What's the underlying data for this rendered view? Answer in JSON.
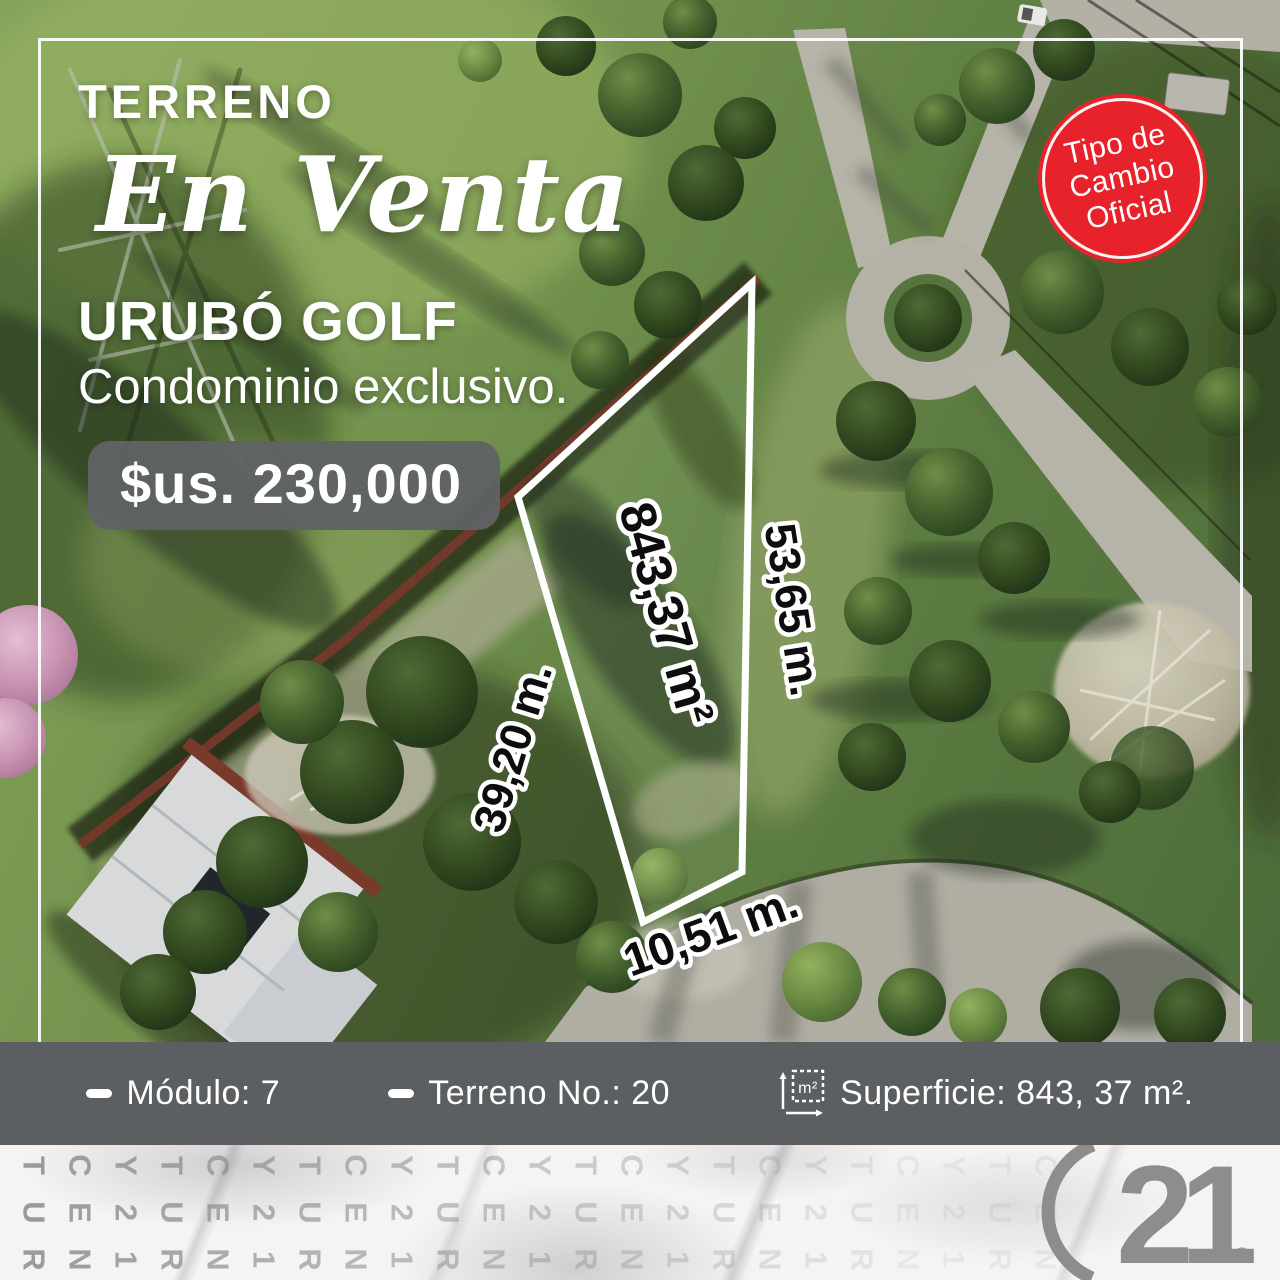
{
  "header": {
    "kicker": "TERRENO",
    "script_title": "En Venta",
    "location": "URUBÓ GOLF",
    "subtitle": "Condominio exclusivo.",
    "price": "$us. 230,000"
  },
  "exchange_badge": {
    "lines": [
      "Tipo de",
      "Cambio",
      "Oficial"
    ],
    "bg_color": "#e7222b",
    "text_color": "#ffffff"
  },
  "plot": {
    "area_label": "843,37 m²",
    "side_right": "53,65 m.",
    "side_left": "39,20 m.",
    "side_bottom": "10,51 m.",
    "outline_color": "#ffffff"
  },
  "info_bar": {
    "bg_color": "#5c5f62",
    "modulo": {
      "text": "Módulo: 7"
    },
    "terreno": {
      "text": "Terreno No.: 20"
    },
    "superficie": {
      "text": "Superficie: 843, 37 m².",
      "icon_label": "m²"
    }
  },
  "footer": {
    "watermark": {
      "pattern": [
        "TUR",
        "CEN",
        "Y21"
      ],
      "columns": 23,
      "color": "#8f8f8f"
    },
    "logo": {
      "number": "21",
      "registered": "®",
      "color": "#8f8d8b"
    }
  }
}
